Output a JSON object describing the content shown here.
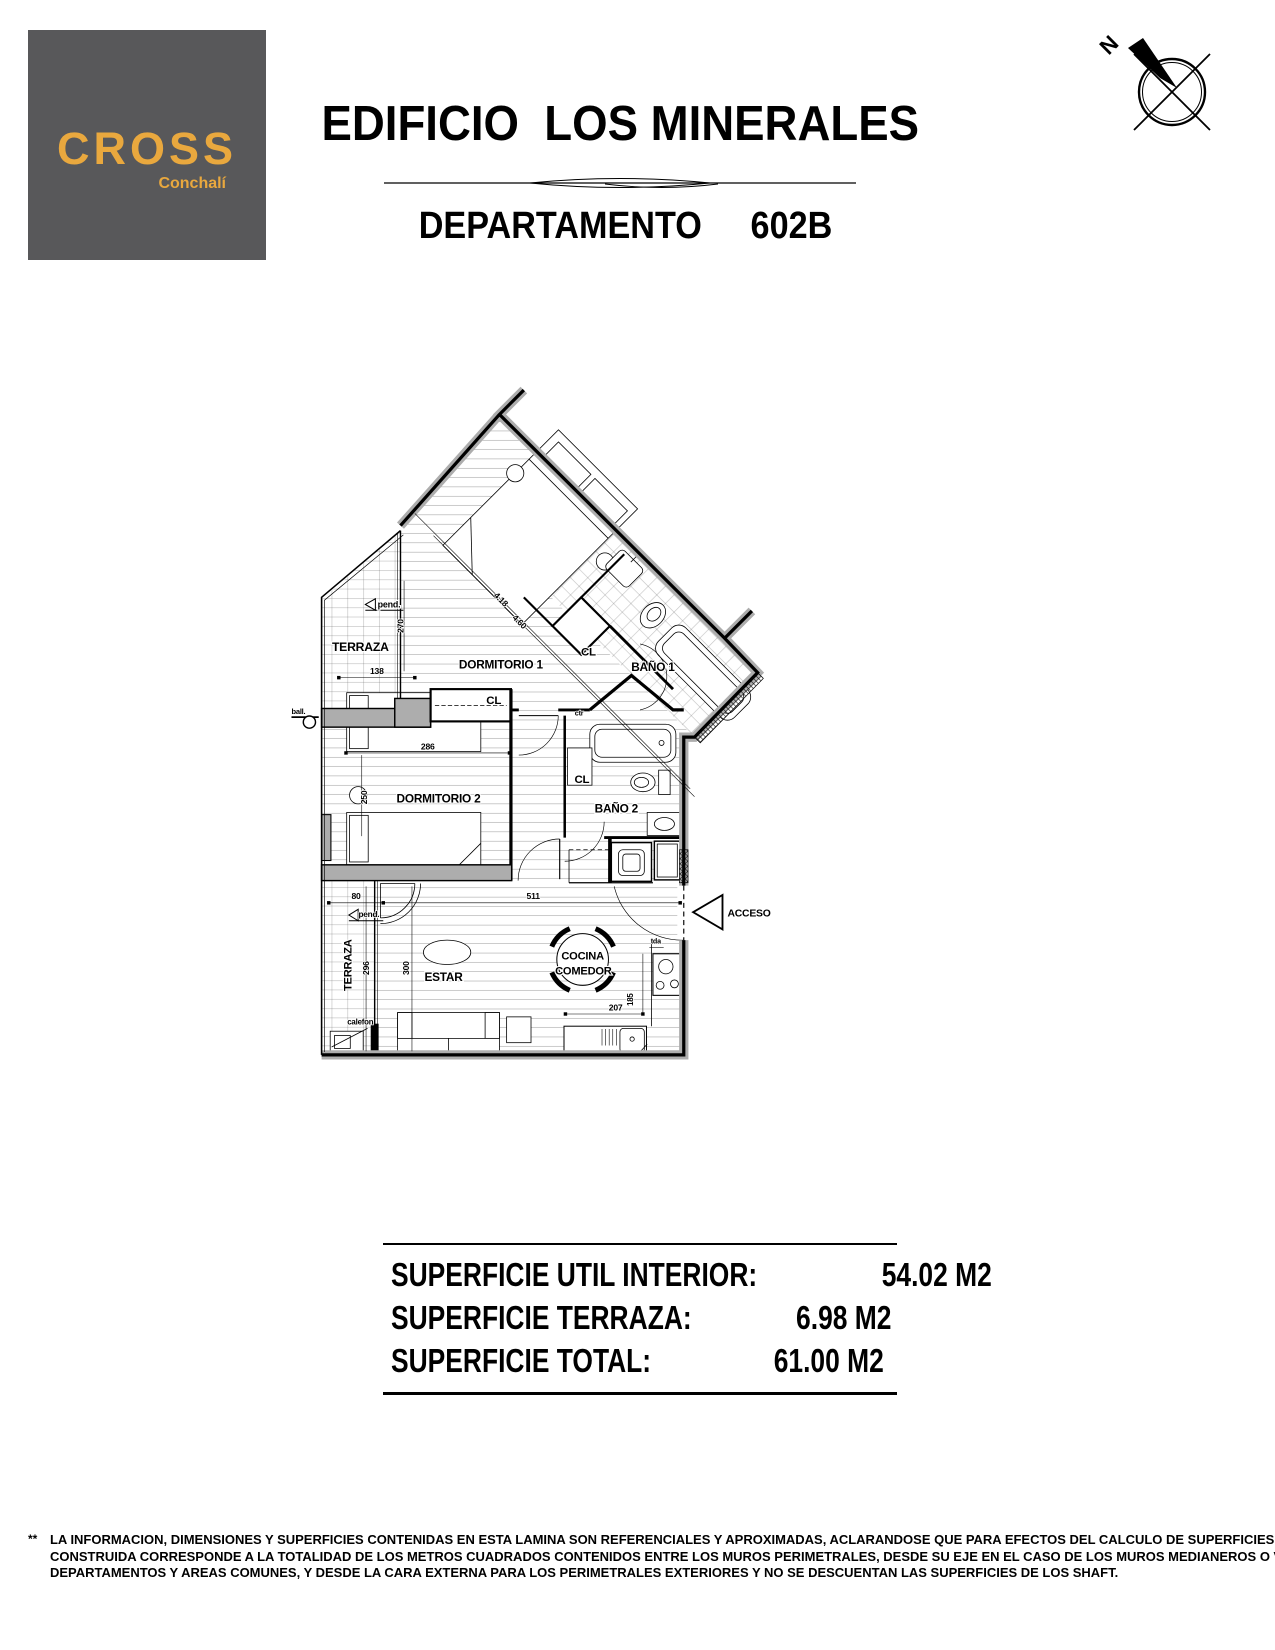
{
  "logo": {
    "brand": "CROSS",
    "location": "Conchalí"
  },
  "header": {
    "building": "EDIFICIO  LOS MINERALES",
    "unit_label": "DEPARTAMENTO",
    "unit_number": "602B"
  },
  "compass": {
    "north": "N"
  },
  "plan": {
    "terraza_upper": "TERRAZA",
    "pend_upper": "pend.",
    "dim_270": "270",
    "dim_138": "138",
    "dormitorio1": "DORMITORIO 1",
    "dim_diag_a": "4.18",
    "dim_diag_b": "4.60",
    "cl_dorm1": "CL",
    "bano1": "BAÑO 1",
    "cl_dorm2": "CL",
    "ctr": "ctr",
    "dim_286": "286",
    "dormitorio2": "DORMITORIO 2",
    "dim_250": "250",
    "cl_bano2": "CL",
    "bano2": "BAÑO 2",
    "ball": "ball.",
    "dim_80": "80",
    "dim_511": "511",
    "pend_lower": "pend.",
    "terraza_lower": "TERRAZA",
    "dim_296": "296",
    "dim_300": "300",
    "estar": "ESTAR",
    "cocina": "COCINA",
    "comedor": "COMEDOR",
    "dim_207": "207",
    "dim_185": "185",
    "tda": "tda",
    "acceso": "ACCESO",
    "calefon": "calefon"
  },
  "summary": {
    "rows": [
      {
        "label": "SUPERFICIE UTIL INTERIOR:",
        "value": "54.02 M2"
      },
      {
        "label": "SUPERFICIE TERRAZA:",
        "value": "6.98 M2"
      },
      {
        "label": "SUPERFICIE TOTAL:",
        "value": "61.00 M2"
      }
    ]
  },
  "footer": {
    "marker": "**",
    "lines": [
      "LA INFORMACION, DIMENSIONES Y SUPERFICIES CONTENIDAS EN ESTA LAMINA SON REFERENCIALES Y APROXIMADAS, ACLARANDOSE QUE PARA EFECTOS DEL CALCULO DE SUPERFICIES,  LA  SUPERFICIE",
      "CONSTRUIDA CORRESPONDE A LA TOTALIDAD DE LOS METROS CUADRADOS CONTENIDOS ENTRE LOS MUROS PERIMETRALES, DESDE SU EJE EN EL CASO DE LOS MUROS MEDIANEROS O VECINOS A OTROS",
      "DEPARTAMENTOS Y AREAS COMUNES, Y DESDE LA CARA EXTERNA PARA LOS PERIMETRALES EXTERIORES Y NO SE DESCUENTAN LAS SUPERFICIES DE LOS SHAFT."
    ]
  },
  "colors": {
    "brand_gold": "#E9A83E",
    "logo_gray": "#58585A",
    "wall_gray": "#ADADAD"
  }
}
